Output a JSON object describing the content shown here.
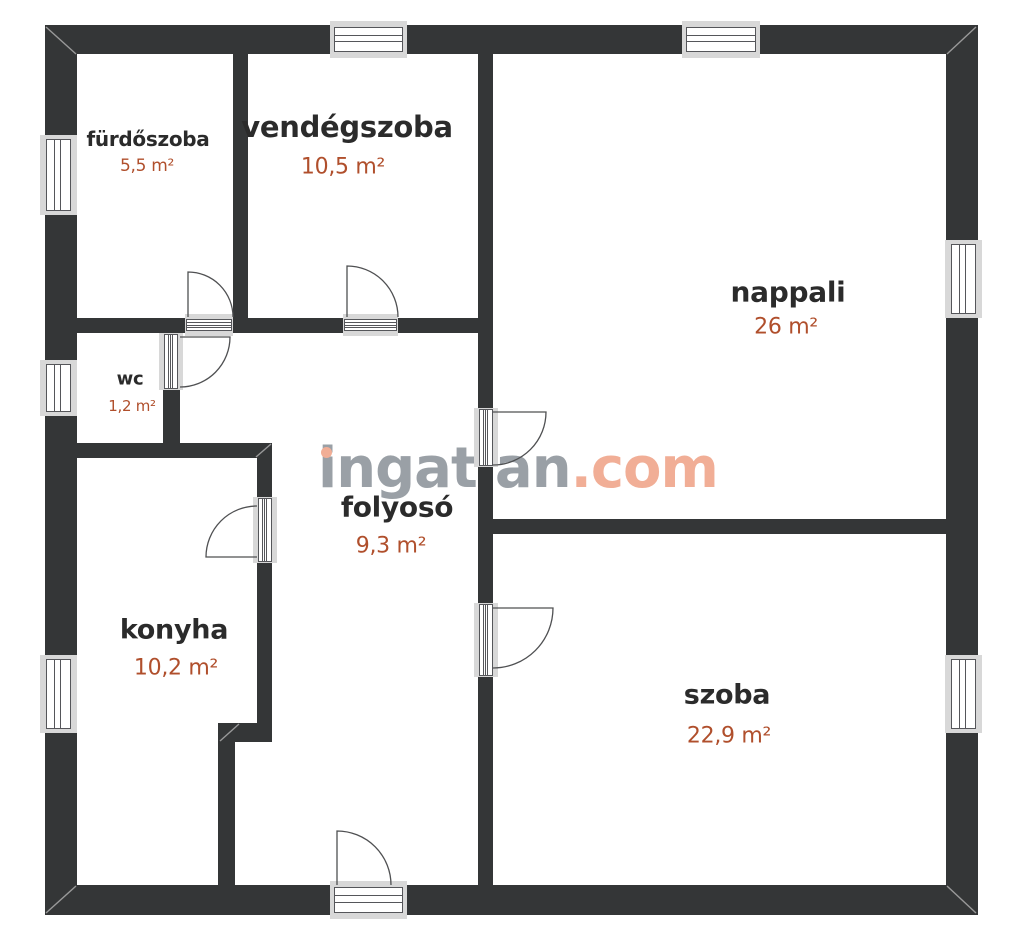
{
  "floorplan": {
    "watermark": {
      "word": "ingatlan",
      "tld": ".com"
    },
    "rooms": [
      {
        "name": "fürdőszoba",
        "area": "5,5 m²"
      },
      {
        "name": "vendégszoba",
        "area": "10,5 m²"
      },
      {
        "name": "nappali",
        "area": "26 m²"
      },
      {
        "name": "wc",
        "area": "1,2 m²"
      },
      {
        "name": "folyosó",
        "area": "9,3 m²"
      },
      {
        "name": "konyha",
        "area": "10,2 m²"
      },
      {
        "name": "szoba",
        "area": "22,9 m²"
      }
    ],
    "colors": {
      "wall": "#343637",
      "room_name": "#2b2b2b",
      "room_area": "#b04f2c",
      "watermark_word": "#9aa0a6",
      "watermark_accent": "#f1ae96",
      "window_frame": "#d8d8d8"
    }
  }
}
